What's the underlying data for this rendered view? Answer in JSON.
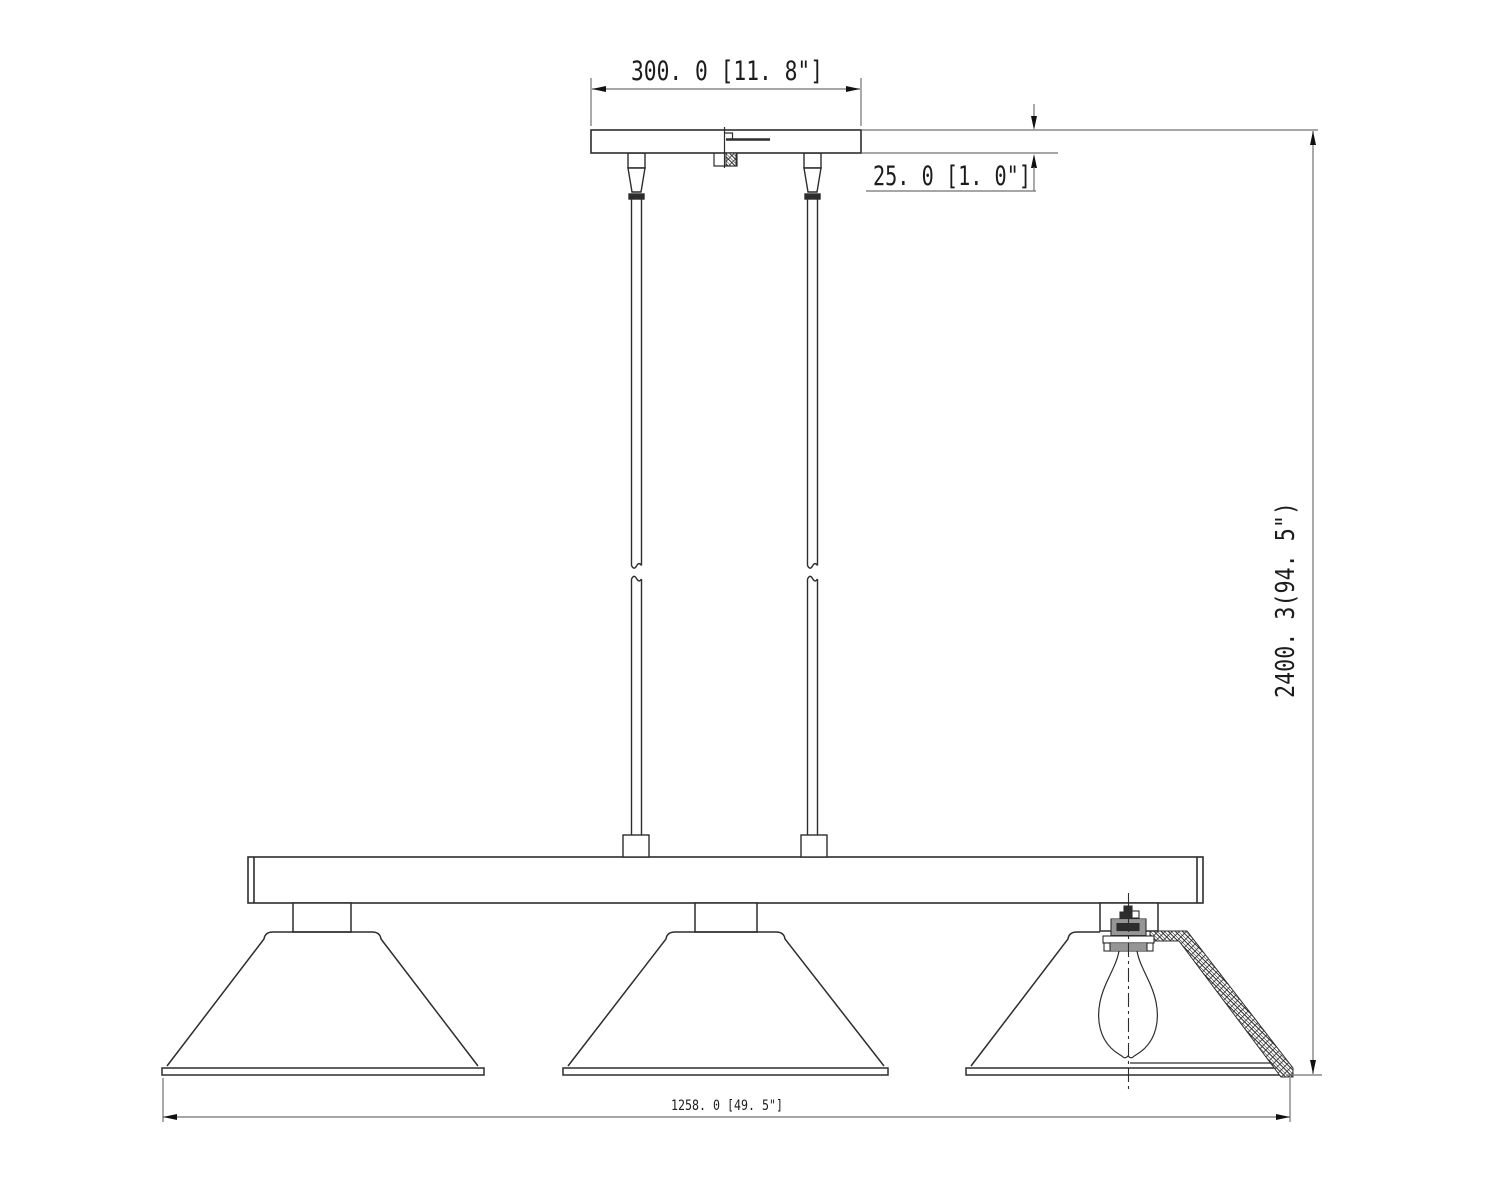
{
  "drawing": {
    "type": "technical-dimension-drawing",
    "subject": "3-light linear pendant fixture elevation",
    "colors": {
      "background": "#ffffff",
      "object_line": "#2d2d2d",
      "dimension_line": "#707070",
      "arrow": "#111111"
    },
    "dimensions": {
      "canopy_width": {
        "label": "300. 0  [11. 8\"]",
        "mm": 300.0,
        "inches": 11.8
      },
      "canopy_thickness": {
        "label": "25. 0 [1. 0\"]",
        "mm": 25.0,
        "inches": 1.0
      },
      "overall_height": {
        "label": "2400. 3(94. 5\")",
        "mm": 2400.3,
        "inches": 94.5
      },
      "fixture_length": {
        "label": "1258. 0 [49. 5\"]",
        "mm": 1258.0,
        "inches": 49.5
      }
    }
  }
}
